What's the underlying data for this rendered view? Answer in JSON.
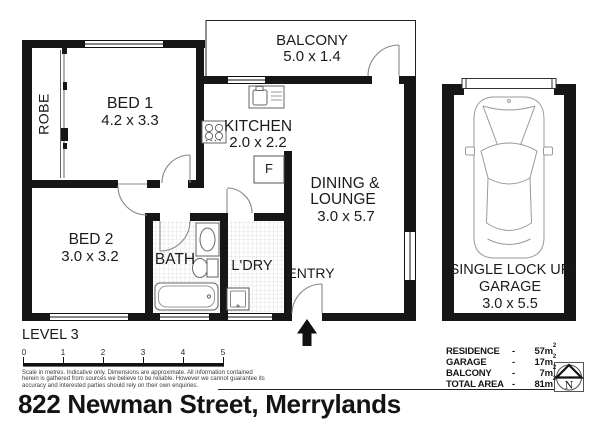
{
  "address": "822 Newman Street, Merrylands",
  "level_label": "LEVEL 3",
  "rooms": {
    "balcony": {
      "name": "BALCONY",
      "dims": "5.0 x 1.4"
    },
    "bed1": {
      "name": "BED 1",
      "dims": "4.2 x 3.3"
    },
    "robe": {
      "name": "ROBE"
    },
    "kitchen": {
      "name": "KITCHEN",
      "dims": "2.0 x 2.2"
    },
    "dining": {
      "line1": "DINING &",
      "line2": "LOUNGE",
      "dims": "3.0 x 5.7"
    },
    "bed2": {
      "name": "BED 2",
      "dims": "3.0 x 3.2"
    },
    "bath": {
      "name": "BATH"
    },
    "laundry": {
      "name": "L'DRY"
    },
    "entry": {
      "name": "ENTRY"
    },
    "garage": {
      "line1": "SINGLE LOCK UP",
      "line2": "GARAGE",
      "dims": "3.0 x 5.5"
    },
    "fridge": {
      "label": "F"
    }
  },
  "scale_bar": {
    "ticks": [
      "0",
      "1",
      "2",
      "3",
      "4",
      "5"
    ]
  },
  "disclaimer": {
    "line1": "Scale in metres. Indicative only. Dimensions are approximate. All information contained",
    "line2": "herein is gathered from sources we believe to be reliable. However we cannot guarantee its",
    "line3": "accuracy and interested parties should rely on their own enquiries."
  },
  "areas": {
    "rows": [
      {
        "label": "RESIDENCE",
        "dash": "-",
        "value": "57m",
        "sup": "2"
      },
      {
        "label": "GARAGE",
        "dash": "-",
        "value": "17m",
        "sup": "2"
      },
      {
        "label": "BALCONY",
        "dash": "-",
        "value": "7m",
        "sup": "2"
      },
      {
        "label": "TOTAL AREA",
        "dash": "-",
        "value": "81m",
        "sup": "2"
      }
    ]
  },
  "compass": {
    "letter": "N"
  }
}
